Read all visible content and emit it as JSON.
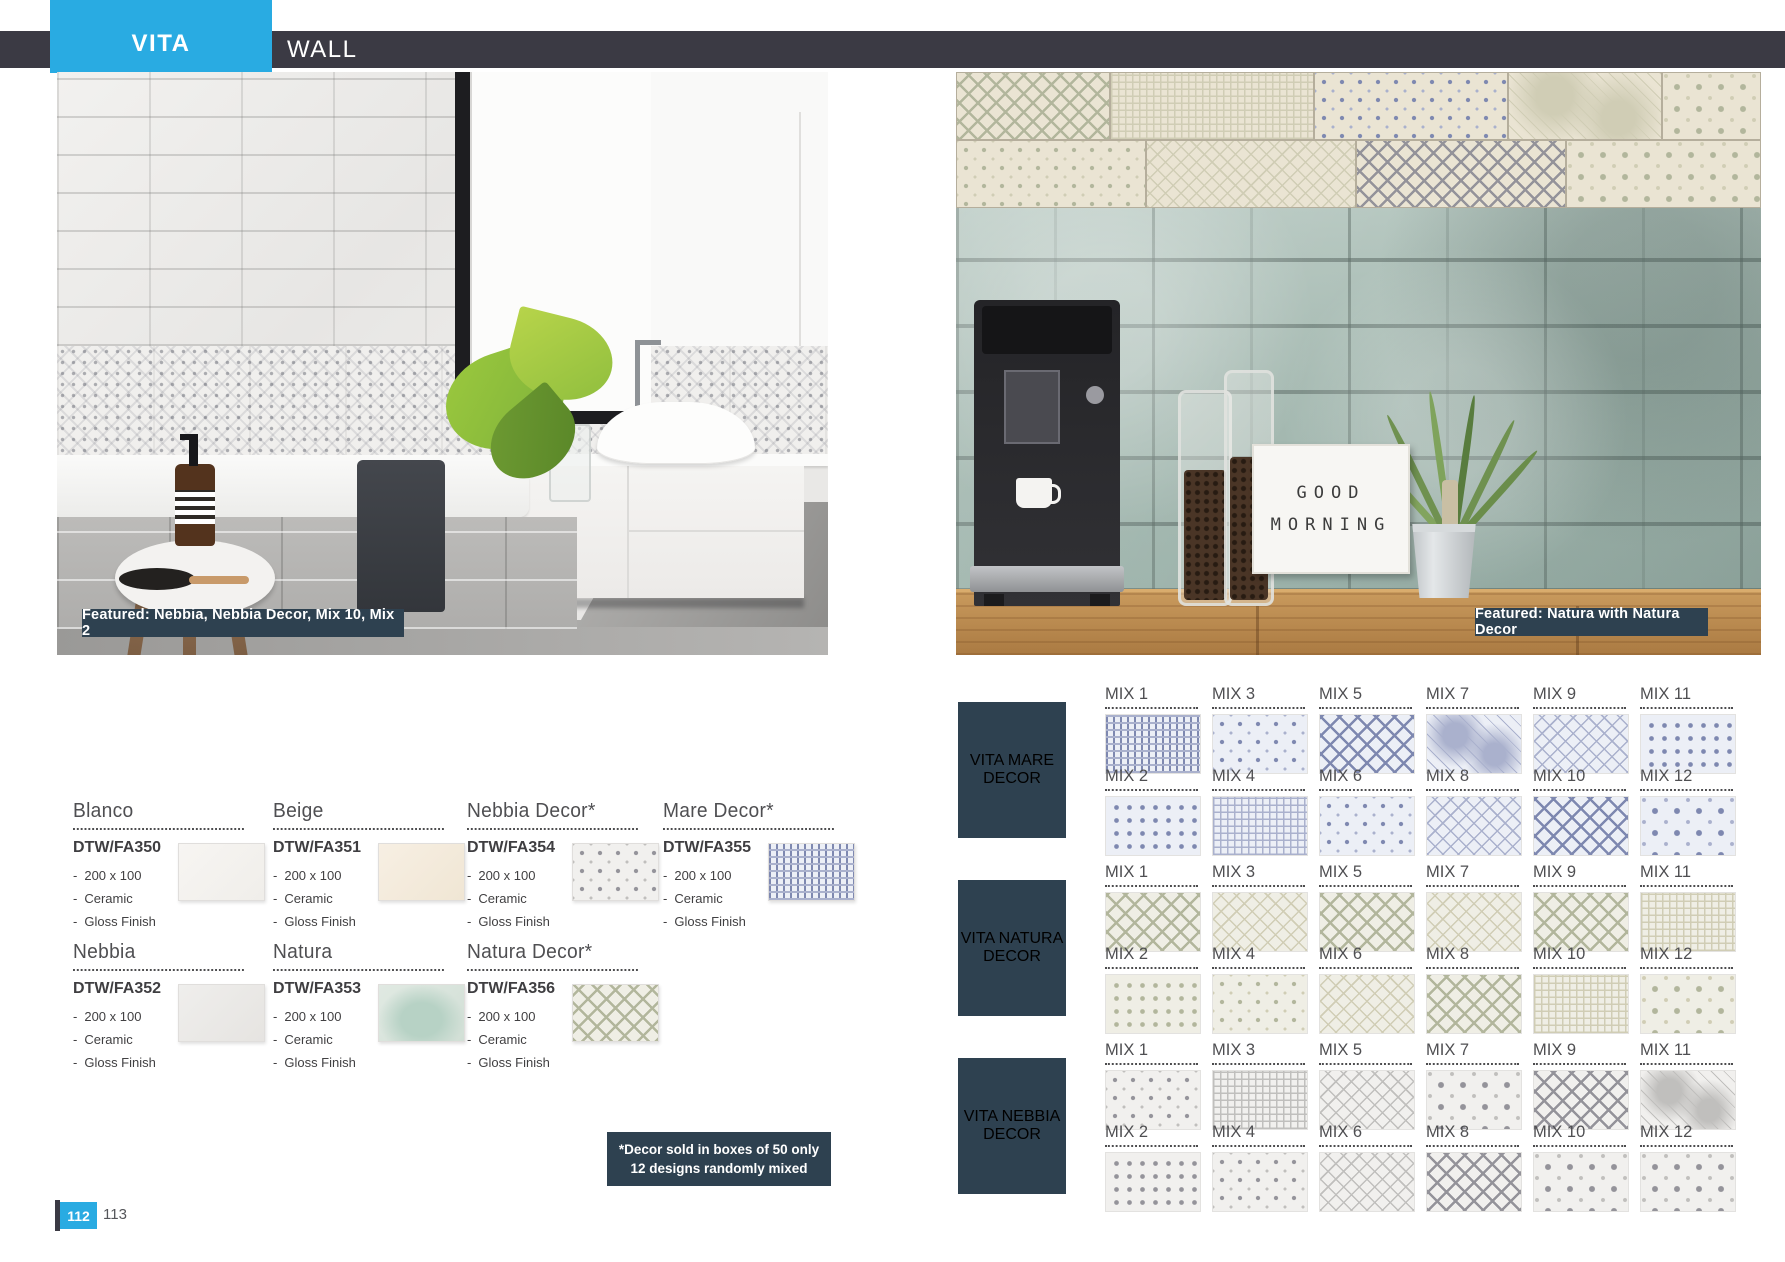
{
  "header": {
    "brand": "VITA",
    "category": "WALL"
  },
  "colors": {
    "accent": "#29abe2",
    "topbar": "#3b3a44",
    "panel": "#2e4150",
    "body_text": "#414042"
  },
  "left_page": {
    "photo_caption": "Featured: Nebbia, Nebbia Decor, Mix 10, Mix 2",
    "spec_bullet": "-",
    "products": [
      {
        "name": "Blanco",
        "code": "DTW/FA350",
        "specs": [
          "200 x 100",
          "Ceramic",
          "Gloss Finish"
        ],
        "row": 1,
        "swatch": "blanco",
        "tint": "",
        "pattern": ""
      },
      {
        "name": "Beige",
        "code": "DTW/FA351",
        "specs": [
          "200 x 100",
          "Ceramic",
          "Gloss Finish"
        ],
        "row": 1,
        "swatch": "beige",
        "tint": "",
        "pattern": ""
      },
      {
        "name": "Nebbia Decor*",
        "code": "DTW/FA354",
        "specs": [
          "200 x 100",
          "Ceramic",
          "Gloss Finish"
        ],
        "row": 1,
        "swatch": "nebbia-decor",
        "tint": "nebbia",
        "pattern": "crosses"
      },
      {
        "name": "Mare Decor*",
        "code": "DTW/FA355",
        "specs": [
          "200 x 100",
          "Ceramic",
          "Gloss Finish"
        ],
        "row": 1,
        "swatch": "mare-decor",
        "tint": "mare",
        "pattern": "weave"
      },
      {
        "name": "Nebbia",
        "code": "DTW/FA352",
        "specs": [
          "200 x 100",
          "Ceramic",
          "Gloss Finish"
        ],
        "row": 2,
        "swatch": "nebbia",
        "tint": "",
        "pattern": ""
      },
      {
        "name": "Natura",
        "code": "DTW/FA353",
        "specs": [
          "200 x 100",
          "Ceramic",
          "Gloss Finish"
        ],
        "row": 2,
        "swatch": "natura",
        "tint": "",
        "pattern": ""
      },
      {
        "name": "Natura Decor*",
        "code": "DTW/FA356",
        "specs": [
          "200 x 100",
          "Ceramic",
          "Gloss Finish"
        ],
        "row": 2,
        "swatch": "natura-decor",
        "tint": "natura",
        "pattern": "lattice-bold"
      }
    ],
    "note": {
      "line1": "*Decor sold in boxes of 50 only",
      "line2": "12 designs randomly mixed"
    },
    "footer": {
      "page_current": "112",
      "page_next": "113"
    }
  },
  "right_page": {
    "photo_caption": "Featured: Natura with Natura Decor",
    "lightbox": {
      "line1": "GOOD",
      "line2": "MORNING"
    },
    "decor_sections": [
      {
        "id": "mare",
        "label_line1": "VITA MARE",
        "label_line2": "DECOR",
        "tint": "mare",
        "rows": [
          [
            {
              "label": "MIX 1",
              "pattern": "weave"
            },
            {
              "label": "MIX 3",
              "pattern": "crosses"
            },
            {
              "label": "MIX 5",
              "pattern": "lattice-bold"
            },
            {
              "label": "MIX 7",
              "pattern": "texture"
            },
            {
              "label": "MIX 9",
              "pattern": "lattice"
            },
            {
              "label": "MIX 11",
              "pattern": "dots"
            }
          ],
          [
            {
              "label": "MIX 2",
              "pattern": "dots"
            },
            {
              "label": "MIX 4",
              "pattern": "grid"
            },
            {
              "label": "MIX 6",
              "pattern": "crosses"
            },
            {
              "label": "MIX 8",
              "pattern": "lattice"
            },
            {
              "label": "MIX 10",
              "pattern": "lattice-bold"
            },
            {
              "label": "MIX 12",
              "pattern": "diamonds"
            }
          ]
        ]
      },
      {
        "id": "natura",
        "label_line1": "VITA NATURA",
        "label_line2": "DECOR",
        "tint": "natura",
        "rows": [
          [
            {
              "label": "MIX 1",
              "pattern": "lattice-bold"
            },
            {
              "label": "MIX 3",
              "pattern": "lattice"
            },
            {
              "label": "MIX 5",
              "pattern": "lattice-bold"
            },
            {
              "label": "MIX 7",
              "pattern": "lattice"
            },
            {
              "label": "MIX 9",
              "pattern": "lattice-bold"
            },
            {
              "label": "MIX 11",
              "pattern": "grid"
            }
          ],
          [
            {
              "label": "MIX 2",
              "pattern": "dots"
            },
            {
              "label": "MIX 4",
              "pattern": "crosses"
            },
            {
              "label": "MIX 6",
              "pattern": "lattice"
            },
            {
              "label": "MIX 8",
              "pattern": "lattice-bold"
            },
            {
              "label": "MIX 10",
              "pattern": "grid"
            },
            {
              "label": "MIX 12",
              "pattern": "diamonds"
            }
          ]
        ]
      },
      {
        "id": "nebbia",
        "label_line1": "VITA NEBBIA",
        "label_line2": "DECOR",
        "tint": "nebbia",
        "rows": [
          [
            {
              "label": "MIX 1",
              "pattern": "crosses"
            },
            {
              "label": "MIX 3",
              "pattern": "grid"
            },
            {
              "label": "MIX 5",
              "pattern": "lattice"
            },
            {
              "label": "MIX 7",
              "pattern": "diamonds"
            },
            {
              "label": "MIX 9",
              "pattern": "lattice-bold"
            },
            {
              "label": "MIX 11",
              "pattern": "texture"
            }
          ],
          [
            {
              "label": "MIX 2",
              "pattern": "dots"
            },
            {
              "label": "MIX 4",
              "pattern": "crosses"
            },
            {
              "label": "MIX 6",
              "pattern": "lattice"
            },
            {
              "label": "MIX 8",
              "pattern": "lattice-bold"
            },
            {
              "label": "MIX 10",
              "pattern": "diamonds"
            },
            {
              "label": "MIX 12",
              "pattern": "diamonds"
            }
          ]
        ]
      }
    ]
  }
}
